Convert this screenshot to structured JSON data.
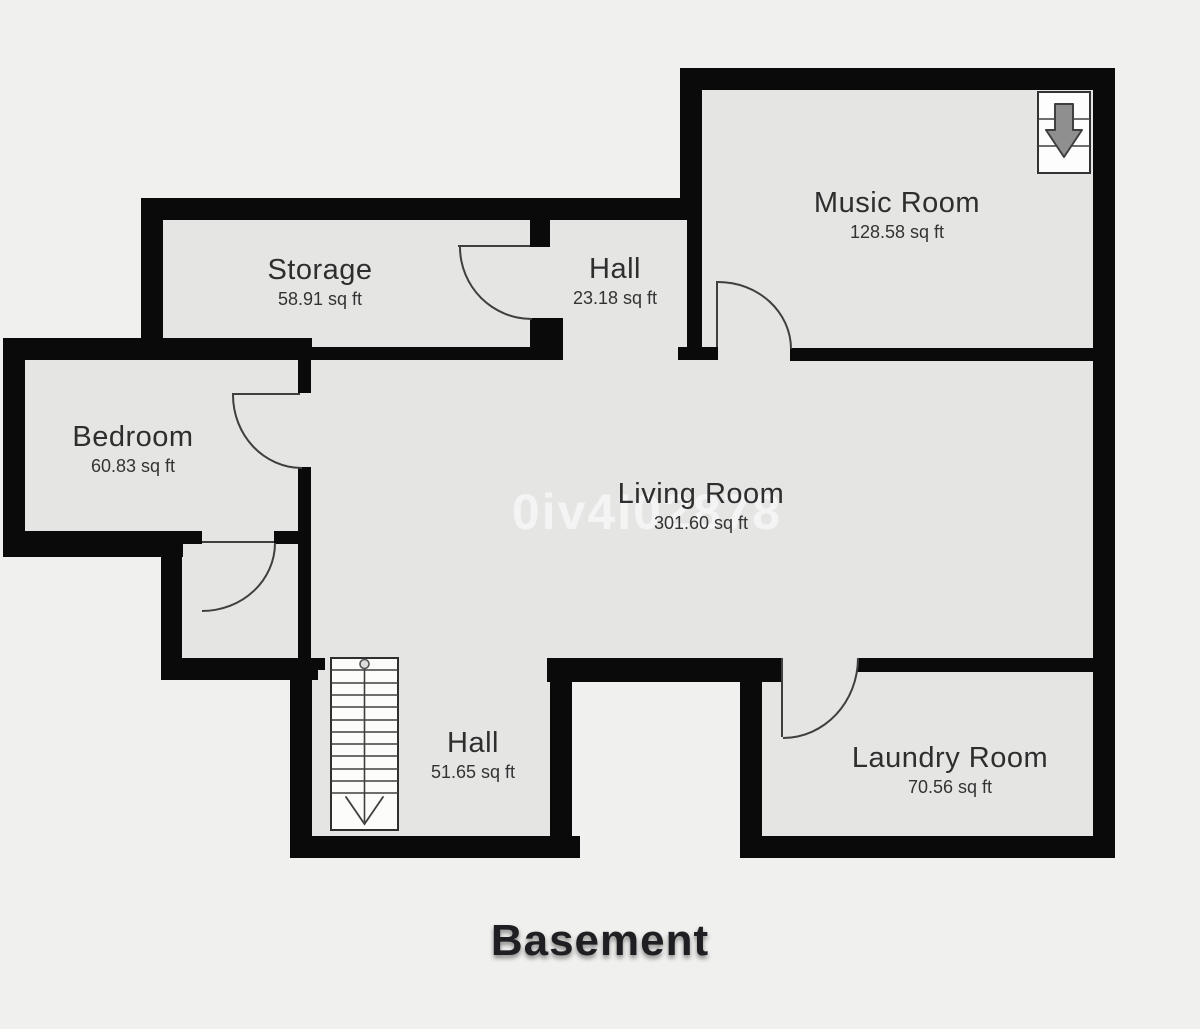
{
  "floor": {
    "title": "Basement"
  },
  "watermark": "0iv4I02878",
  "rooms": [
    {
      "name": "Storage",
      "area": "58.91 sq ft"
    },
    {
      "name": "Hall",
      "area": "23.18 sq ft"
    },
    {
      "name": "Music Room",
      "area": "128.58 sq ft"
    },
    {
      "name": "Bedroom",
      "area": "60.83 sq ft"
    },
    {
      "name": "Living Room",
      "area": "301.60 sq ft"
    },
    {
      "name": "Hall",
      "area": "51.65 sq ft"
    },
    {
      "name": "Laundry Room",
      "area": "70.56 sq ft"
    }
  ],
  "icons": {
    "upper_right": "stairs-down-arrow-icon",
    "lower_hall": "staircase-icon"
  },
  "colors": {
    "background": "#f0f0ee",
    "room_fill": "#e5e6e4",
    "wall": "#0a0a0a",
    "door_line": "#3f3f3f",
    "stair_arrow_fill": "#8f8f8f",
    "label_text": "#2e2e2e",
    "title_text": "#1f1f23",
    "watermark_text": "rgba(255,255,255,0.55)"
  }
}
